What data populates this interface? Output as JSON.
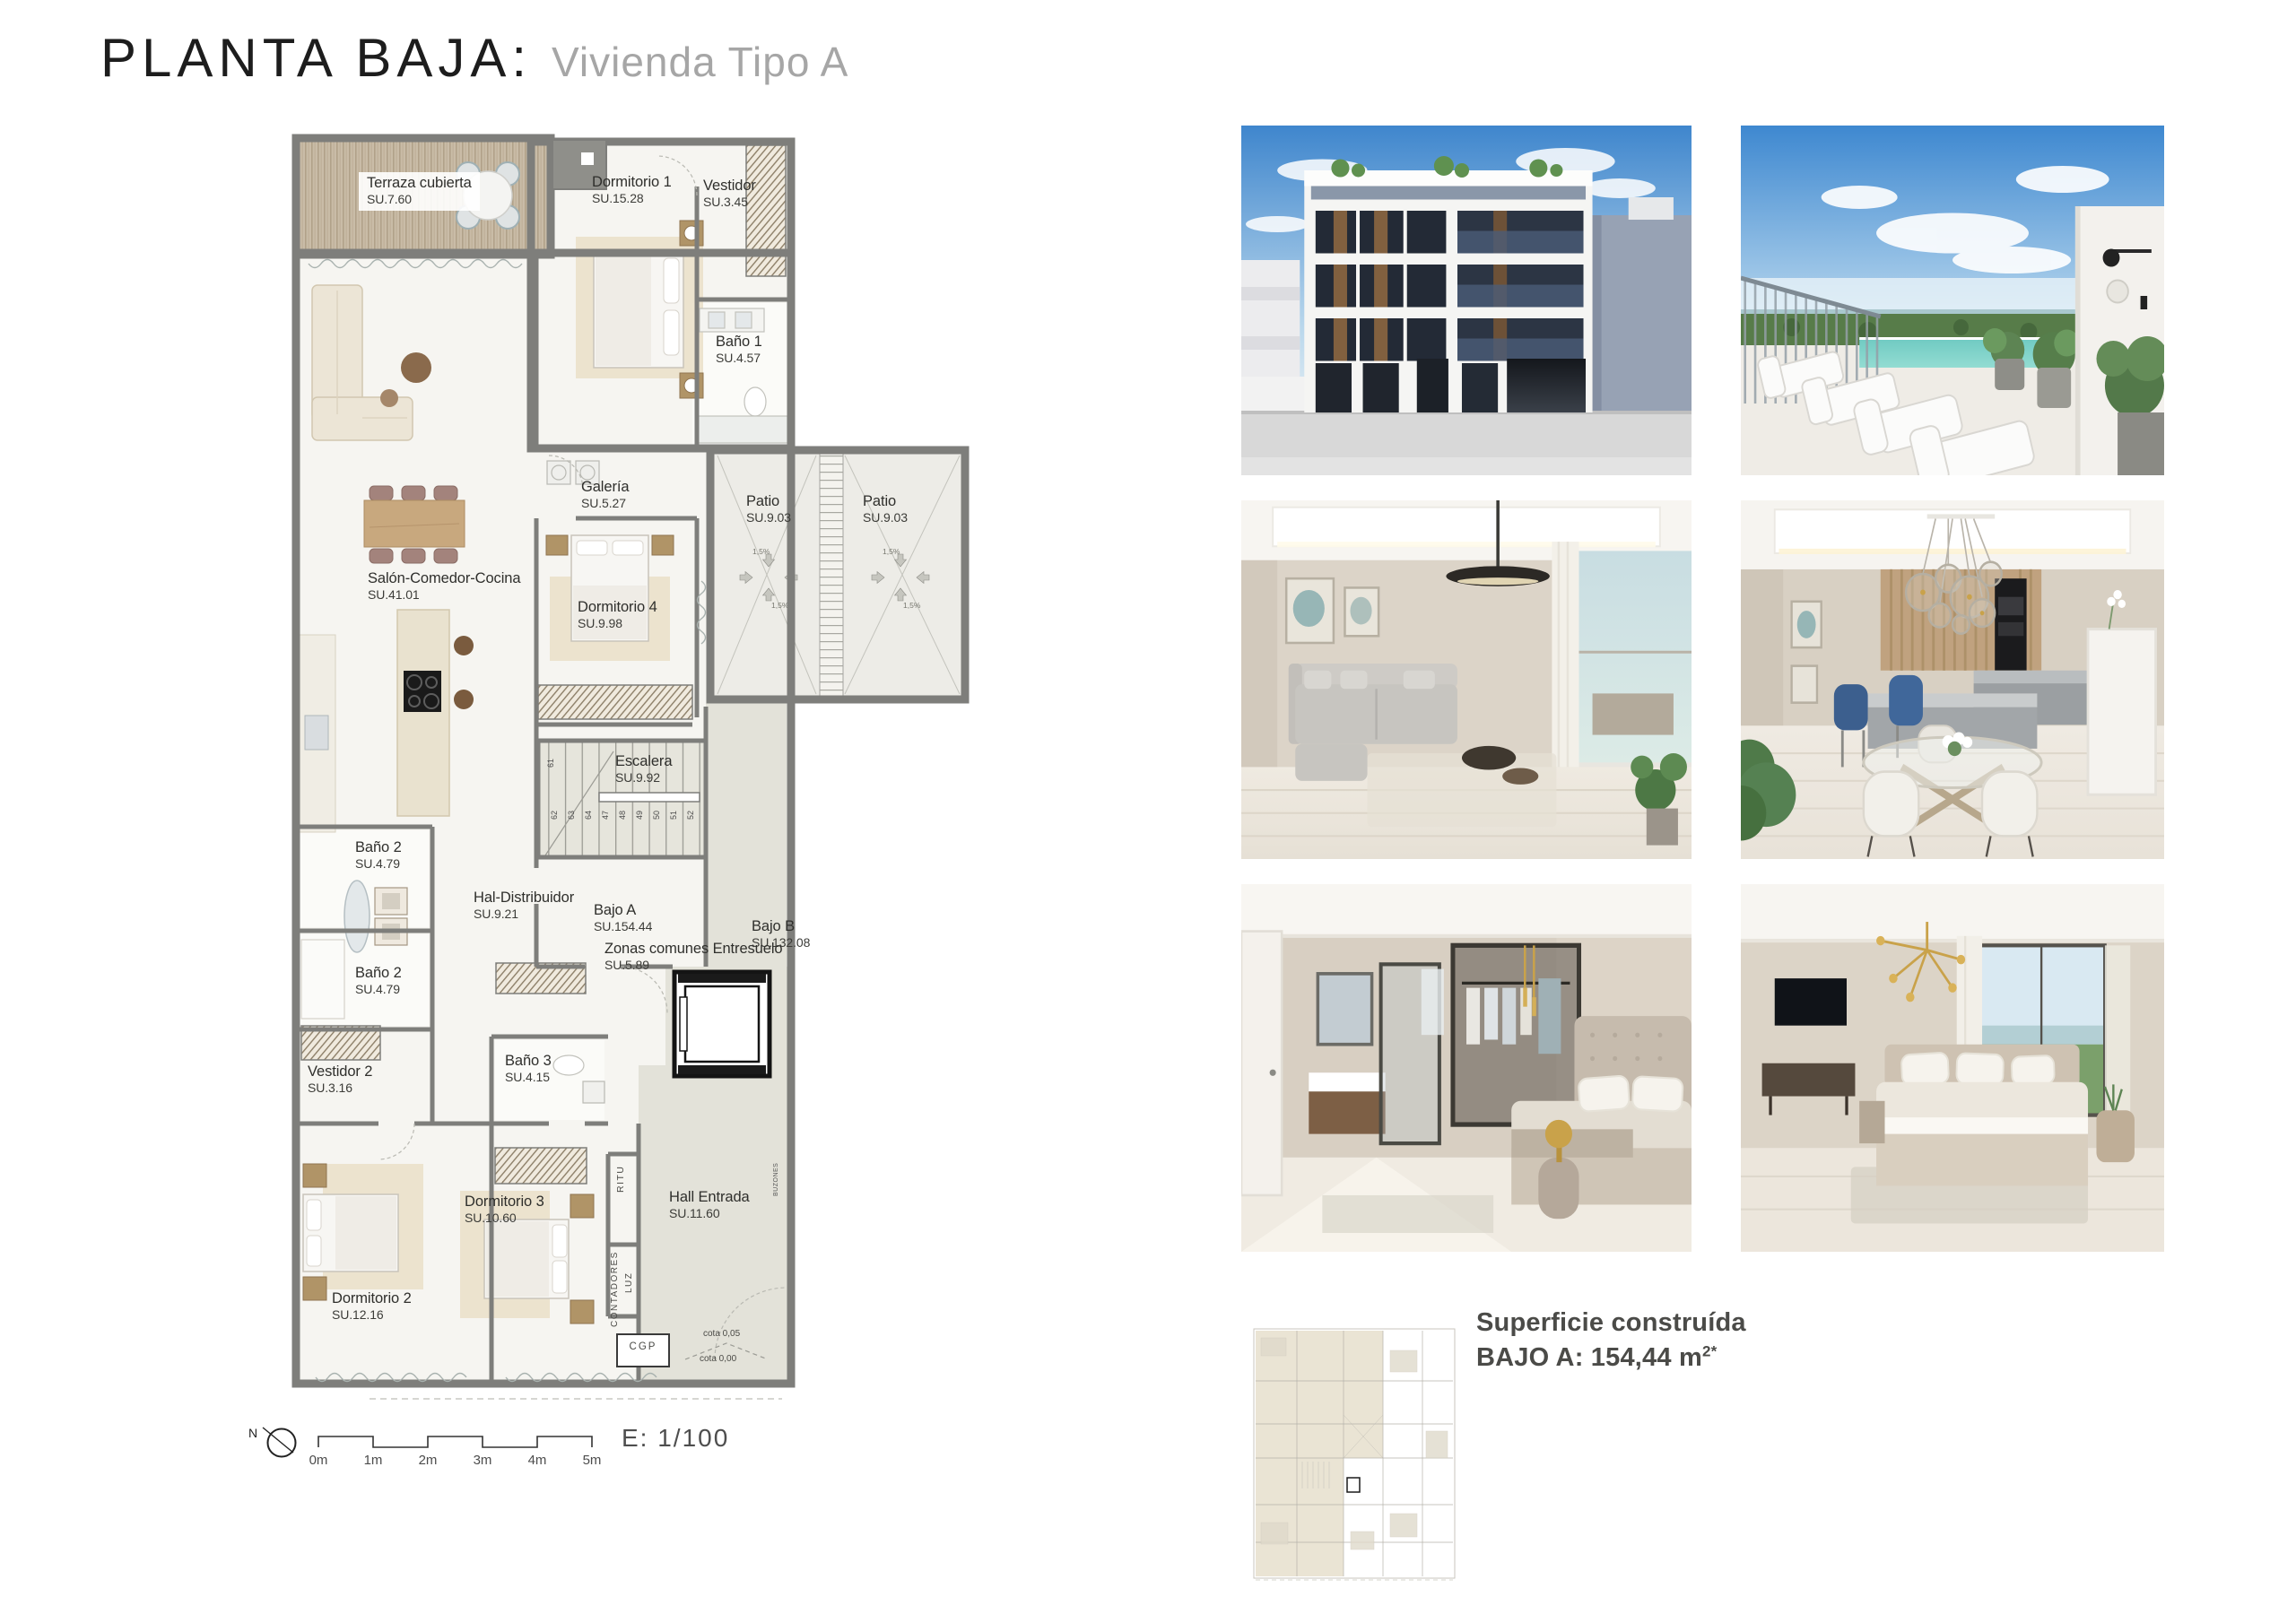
{
  "title": {
    "main": "PLANTA BAJA:",
    "sub": "Vivienda Tipo A"
  },
  "plan": {
    "rooms": [
      {
        "name": "Terraza cubierta",
        "area": "SU.7.60"
      },
      {
        "name": "Dormitorio 1",
        "area": "SU.15.28"
      },
      {
        "name": "Vestidor",
        "area": "SU.3.45"
      },
      {
        "name": "Baño 1",
        "area": "SU.4.57"
      },
      {
        "name": "Galería",
        "area": "SU.5.27"
      },
      {
        "name": "Patio",
        "area": "SU.9.03"
      },
      {
        "name": "Patio",
        "area": "SU.9.03"
      },
      {
        "name": "Salón-Comedor-Cocina",
        "area": "SU.41.01"
      },
      {
        "name": "Dormitorio 4",
        "area": "SU.9.98"
      },
      {
        "name": "Escalera",
        "area": "SU.9.92"
      },
      {
        "name": "Baño 2",
        "area": "SU.4.79"
      },
      {
        "name": "Baño 2",
        "area": "SU.4.79"
      },
      {
        "name": "Hal-Distribuidor",
        "area": "SU.9.21"
      },
      {
        "name": "Bajo A",
        "area": "SU.154.44"
      },
      {
        "name": "Bajo B",
        "area": "SU.132.08"
      },
      {
        "name": "Zonas comunes Entresuelo",
        "area": "SU.5.89"
      },
      {
        "name": "Baño 3",
        "area": "SU.4.15"
      },
      {
        "name": "Vestidor 2",
        "area": "SU.3.16"
      },
      {
        "name": "Dormitorio 3",
        "area": "SU.10.60"
      },
      {
        "name": "Hall Entrada",
        "area": "SU.11.60"
      },
      {
        "name": "Dormitorio 2",
        "area": "SU.12.16"
      }
    ],
    "stair_numbers": [
      "61",
      "62",
      "63",
      "64",
      "47",
      "48",
      "49",
      "50",
      "51",
      "52"
    ],
    "slope": "1,5%",
    "annotations": {
      "cgp": "CGP",
      "cota_top": "cota 0,05",
      "cota_bottom": "cota 0,00",
      "ritu": "RITU",
      "contadores": "CONTADORES",
      "luz": "LUZ",
      "buzones": "BUZONES"
    }
  },
  "scalebar": {
    "north": "N",
    "ticks": [
      "0m",
      "1m",
      "2m",
      "3m",
      "4m",
      "5m"
    ],
    "scale": "E: 1/100"
  },
  "summary": {
    "line1": "Superficie construída",
    "line2": "BAJO A: 154,44 m",
    "line2_sup": "2*"
  },
  "photos": [
    {
      "name": "building-facade"
    },
    {
      "name": "roof-terrace-pool"
    },
    {
      "name": "living-room"
    },
    {
      "name": "dining-kitchen"
    },
    {
      "name": "bedroom-ensuite"
    },
    {
      "name": "bedroom"
    }
  ]
}
